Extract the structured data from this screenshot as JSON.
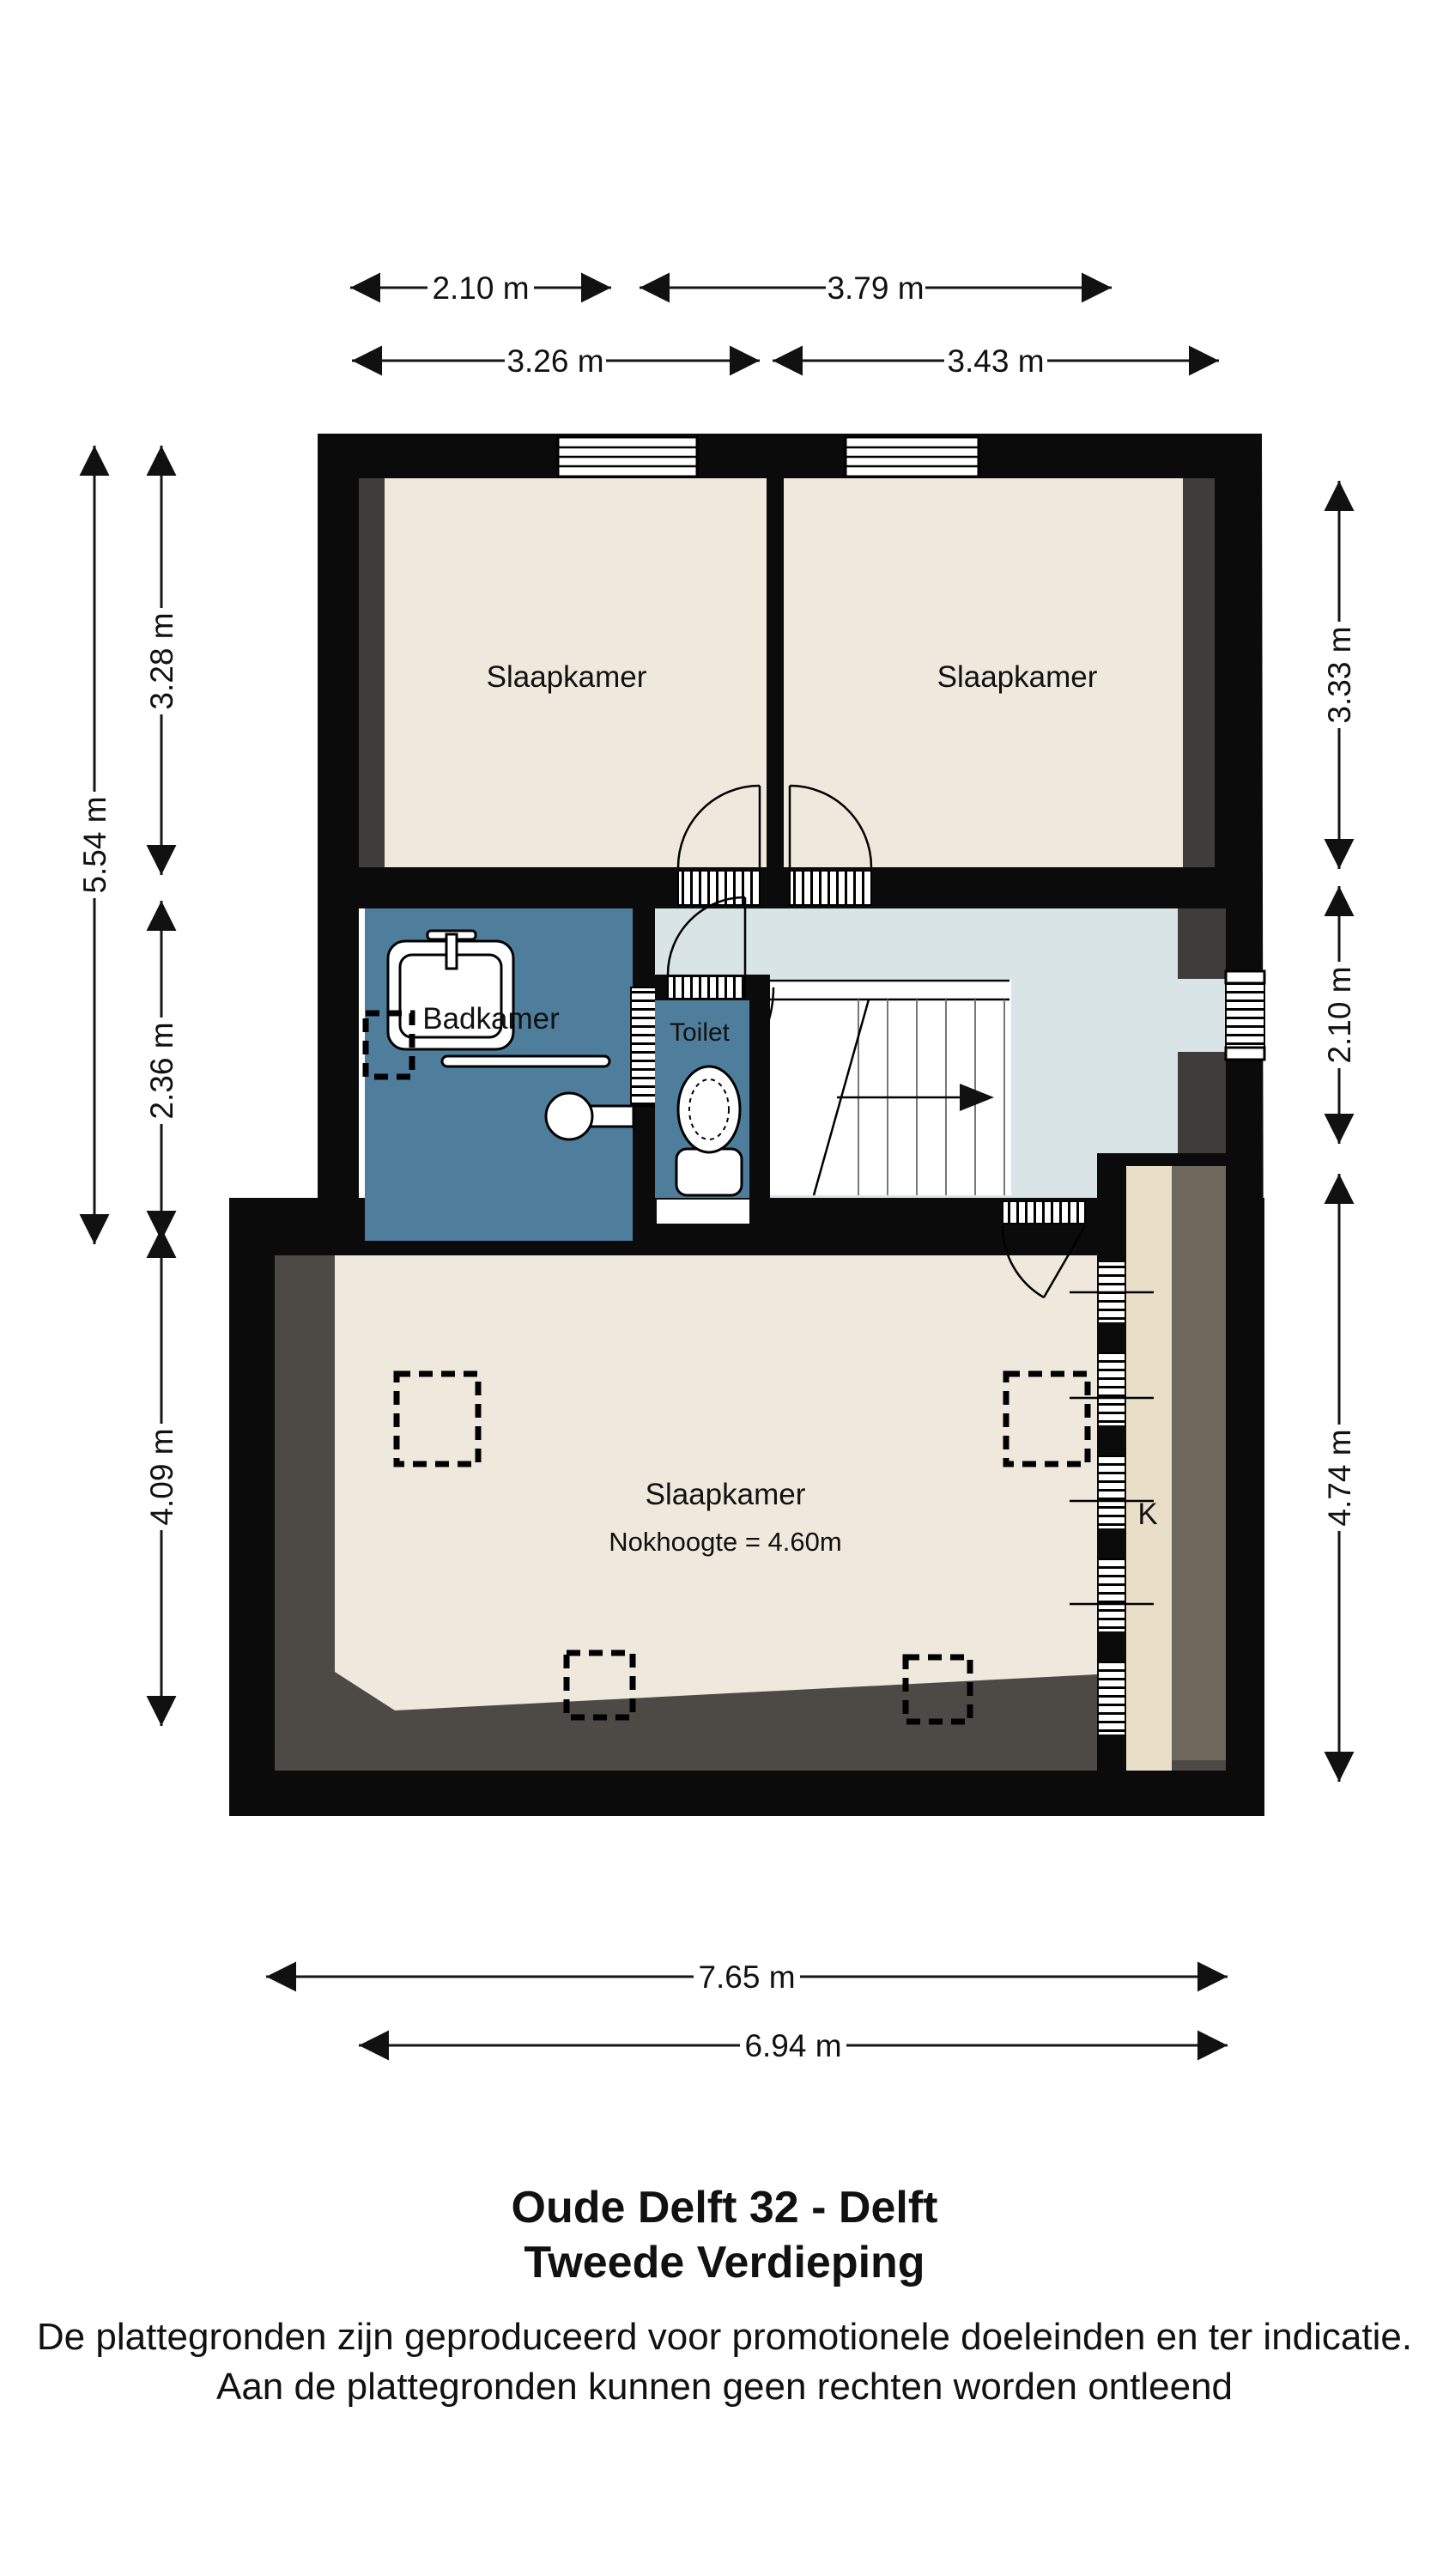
{
  "title": {
    "line1": "Oude Delft 32 - Delft",
    "line2": "Tweede Verdieping"
  },
  "disclaimer": {
    "line1": "De plattegronden zijn geproduceerd voor promotionele doeleinden en ter indicatie.",
    "line2": "Aan de plattegronden kunnen geen rechten worden ontleend"
  },
  "rooms": {
    "bedroom_top_left": {
      "label": "Slaapkamer"
    },
    "bedroom_top_right": {
      "label": "Slaapkamer"
    },
    "bathroom": {
      "label": "Badkamer"
    },
    "toilet": {
      "label": "Toilet"
    },
    "landing": {
      "label": "Overloop"
    },
    "attic_bedroom": {
      "label": "Slaapkamer",
      "note": "Nokhoogte = 4.60m"
    },
    "closet": {
      "label": "K"
    }
  },
  "dimensions": {
    "top": [
      {
        "label": "2.10 m"
      },
      {
        "label": "3.79 m"
      },
      {
        "label": "3.26 m"
      },
      {
        "label": "3.43 m"
      }
    ],
    "left": [
      {
        "label": "5.54 m"
      },
      {
        "label": "3.28 m"
      },
      {
        "label": "2.36 m"
      },
      {
        "label": "4.09 m"
      }
    ],
    "right": [
      {
        "label": "3.33 m"
      },
      {
        "label": "2.10 m"
      },
      {
        "label": "4.74 m"
      }
    ],
    "bottom": [
      {
        "label": "7.65 m"
      },
      {
        "label": "6.94 m"
      }
    ]
  },
  "colors": {
    "wall": "#0B0B0B",
    "floor": "#EFE8DC",
    "floor_warm": "#E9DFC8",
    "bathroom_blue": "#4E7E9C",
    "landing_blue": "#D9E4E7",
    "slope_gray": "#4D4A45",
    "strip_gray": "#3E3D3B",
    "slope_warm": "#6E675C",
    "background": "#FFFFFF",
    "line": "#161616"
  }
}
